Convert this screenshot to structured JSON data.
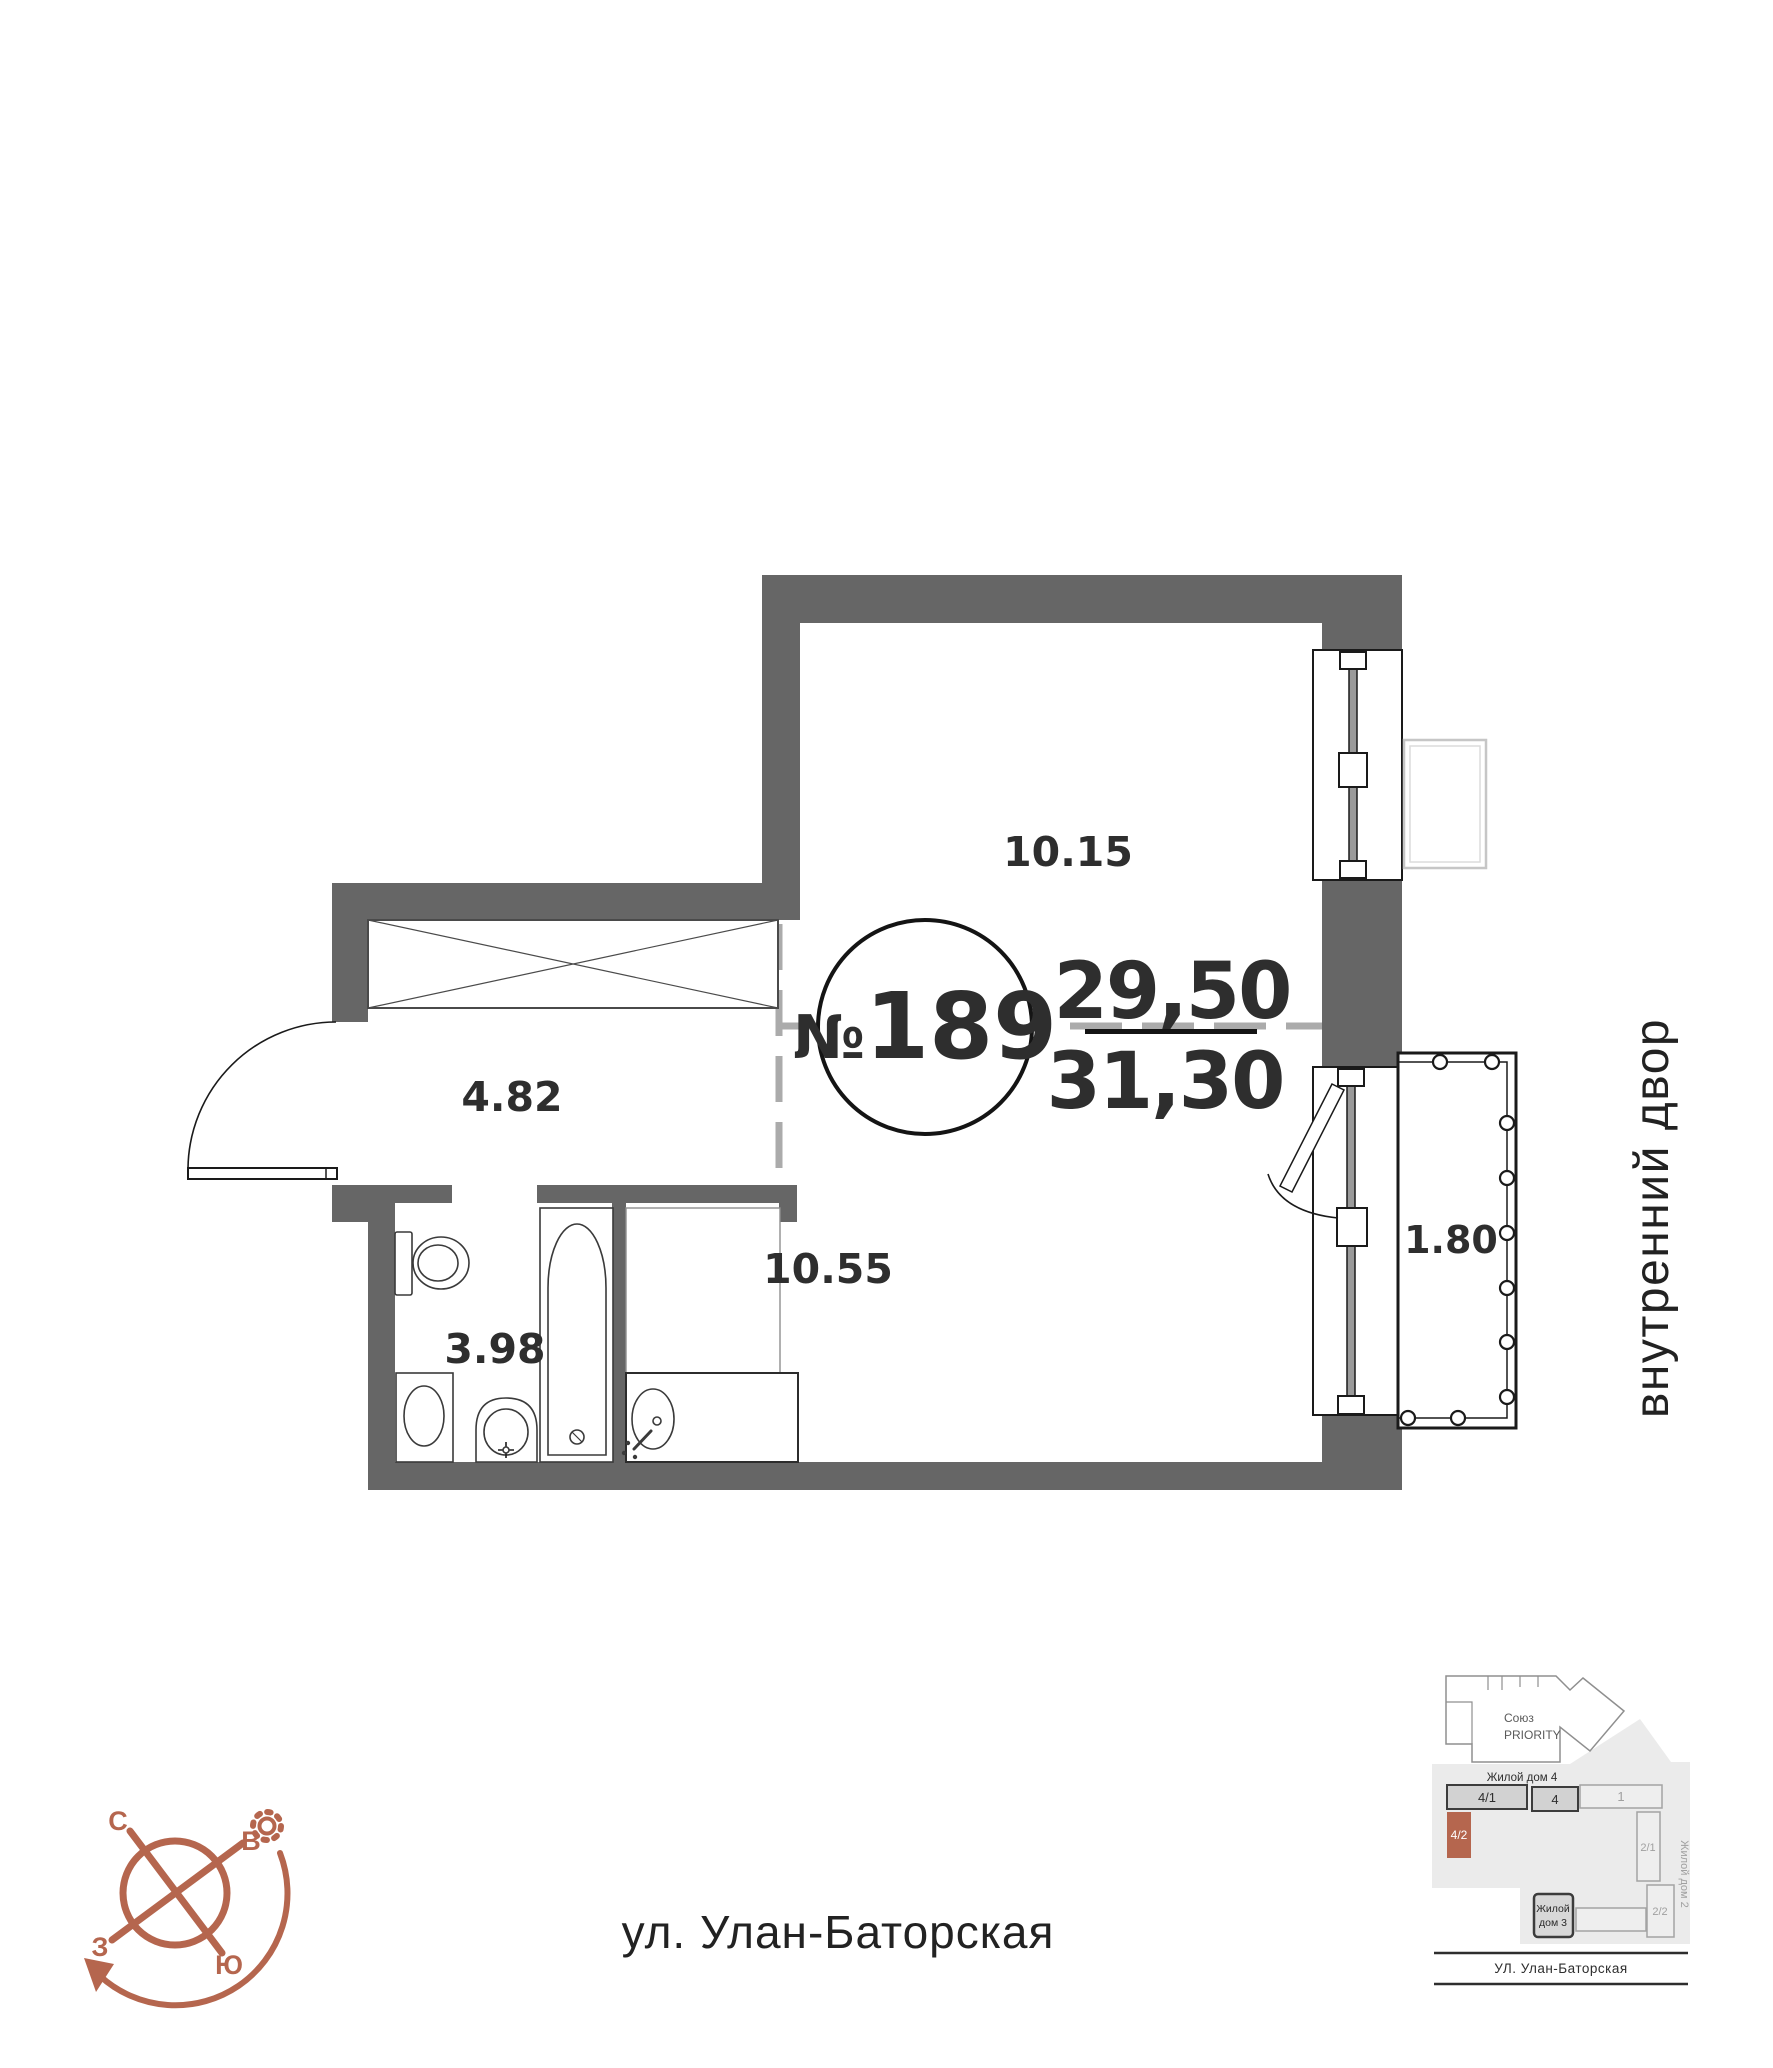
{
  "plan": {
    "number_sign": "№",
    "number": "189",
    "area_upper": "29,50",
    "area_lower": "31,30",
    "rooms": {
      "living": "10.15",
      "hallway": "4.82",
      "bathroom": "3.98",
      "kitchen": "10.55",
      "balcony": "1.80"
    }
  },
  "compass": {
    "n": "С",
    "e": "В",
    "w": "З",
    "s": "Ю"
  },
  "labels": {
    "street": "ул. Улан-Баторская",
    "courtyard": "внутренний двор"
  },
  "minimap": {
    "complex_name_1": "Союз",
    "complex_name_2": "PRIORITY",
    "house4": "Жилой дом 4",
    "b_4_1": "4/1",
    "b_4": "4",
    "b_1": "1",
    "b_4_2": "4/2",
    "b_2_1": "2/1",
    "b_2_2": "2/2",
    "house3_line1": "Жилой",
    "house3_line2": "дом 3",
    "house2": "Жилой дом 2",
    "street": "УЛ. Улан-Баторская"
  },
  "colors": {
    "wall": "#666666",
    "accent": "#b5664e",
    "dash": "#ababab"
  }
}
